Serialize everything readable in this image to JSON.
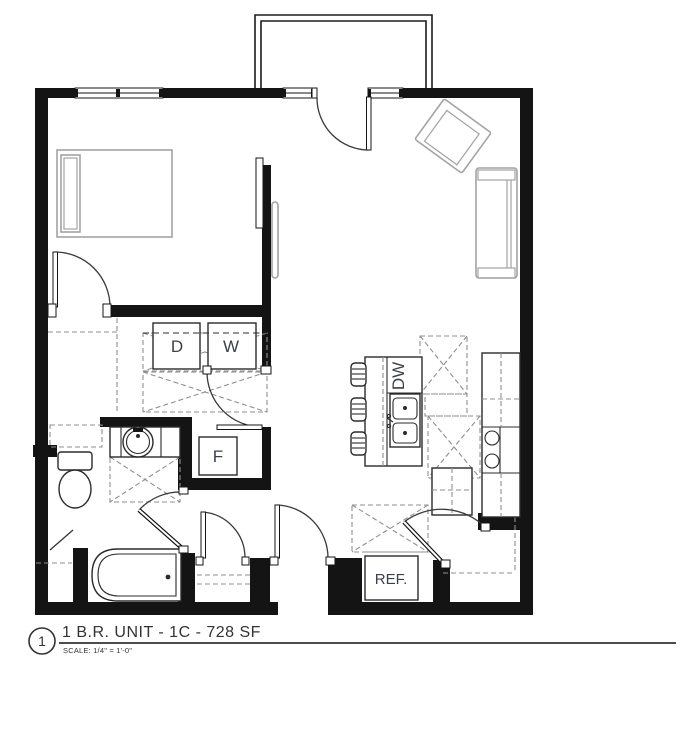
{
  "plan": {
    "labels": {
      "dryer": "D",
      "washer": "W",
      "utility_closet": "F",
      "dishwasher": "DW",
      "refrigerator": "REF."
    },
    "title_block": {
      "detail_number": "1",
      "title": "1 B.R. UNIT  -  1C - 728 SF",
      "scale": "SCALE: 1/4\" = 1'-0\""
    },
    "colors": {
      "wall": "#141414",
      "furniture_gray": "#a3a3a3",
      "fixture": "#2b2b2b",
      "dashed": "#8f8f8f",
      "label": "#3c4049",
      "title": "#333333"
    }
  }
}
